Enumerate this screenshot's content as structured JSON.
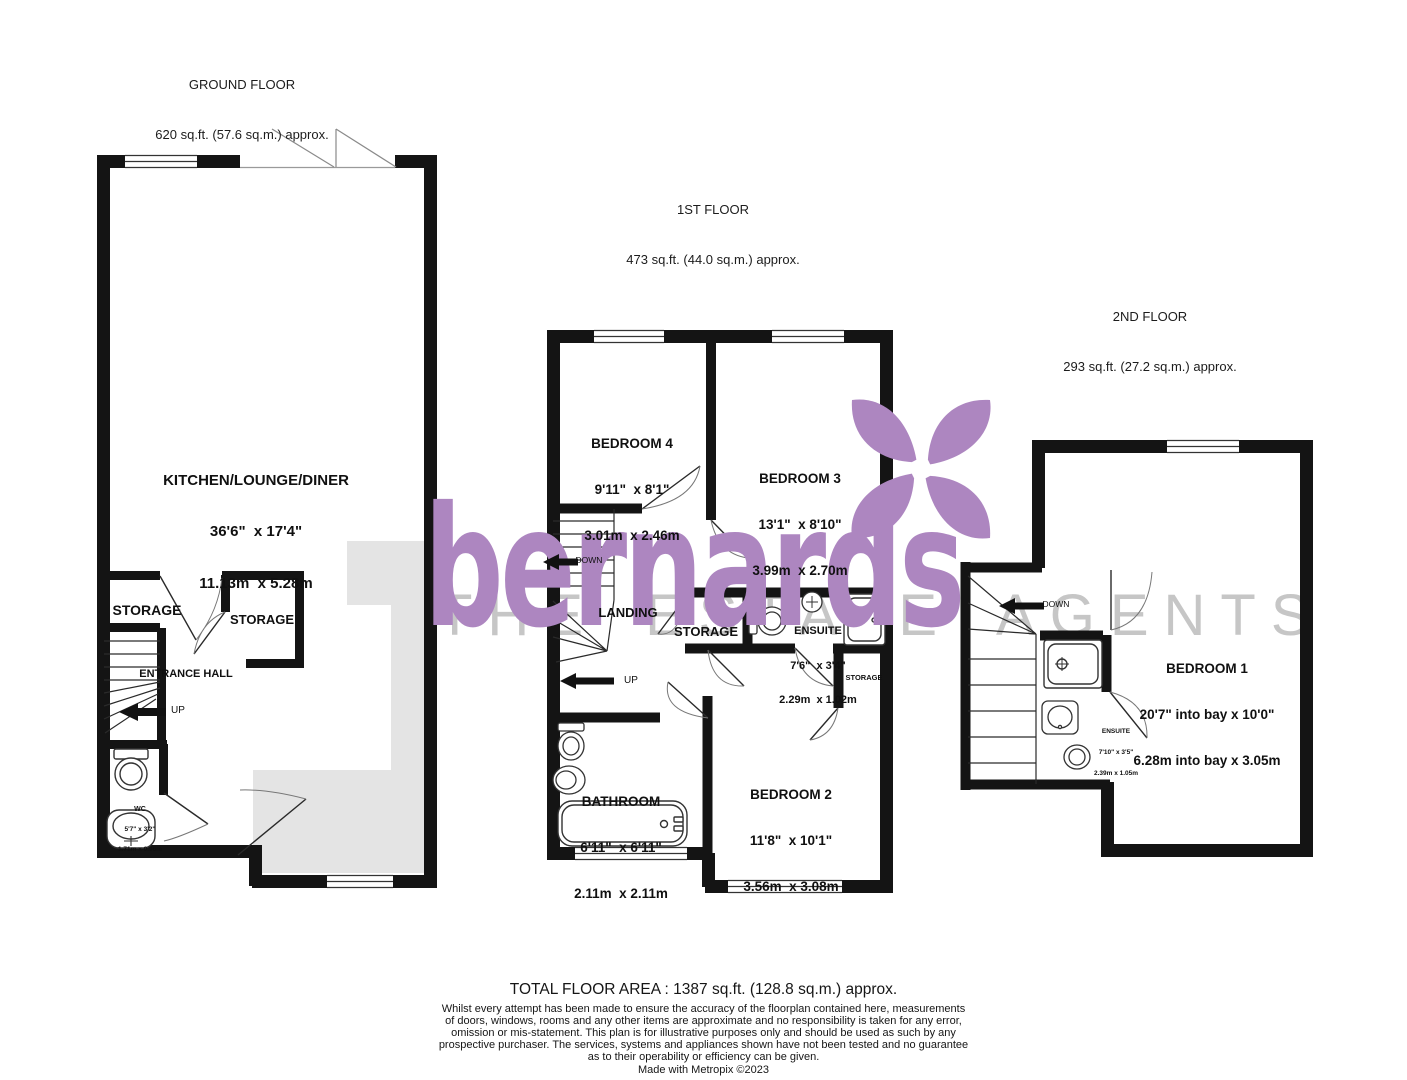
{
  "watermark": {
    "brand": "bernards",
    "tagline": "THE ESTATE AGENTS",
    "brand_color": "#ad86c0",
    "tagline_color": "#c6c6c6",
    "logo_flower": "four-petal-flower-icon"
  },
  "floors": {
    "ground": {
      "title": "GROUND FLOOR",
      "area": "620 sq.ft. (57.6 sq.m.) approx.",
      "kitchen": {
        "name": "KITCHEN/LOUNGE/DINER",
        "imperial": "36'6\"  x 17'4\"",
        "metric": "11.13m  x 5.28m"
      },
      "storage_left": "STORAGE",
      "storage_right": "STORAGE",
      "entrance": "ENTRANCE HALL",
      "wc": {
        "name": "WC",
        "imperial": "5'7\" x 3'2\"",
        "metric": "1.71m x 0.96m"
      },
      "up": "UP"
    },
    "first": {
      "title": "1ST FLOOR",
      "area": "473 sq.ft. (44.0 sq.m.) approx.",
      "bedroom4": {
        "name": "BEDROOM 4",
        "imperial": "9'11\"  x 8'1\"",
        "metric": "3.01m  x 2.46m"
      },
      "bedroom3": {
        "name": "BEDROOM 3",
        "imperial": "13'1\"  x 8'10\"",
        "metric": "3.99m  x 2.70m"
      },
      "landing": "LANDING",
      "storage": "STORAGE",
      "ensuite": {
        "name": "ENSUITE",
        "imperial": "7'6\"  x 3'4\"",
        "metric": "2.29m  x 1.02m"
      },
      "storage_small": "STORAGE",
      "bathroom": {
        "name": "BATHROOM",
        "imperial": "6'11\"  x 6'11\"",
        "metric": "2.11m  x 2.11m"
      },
      "bedroom2": {
        "name": "BEDROOM 2",
        "imperial": "11'8\"  x 10'1\"",
        "metric": "3.56m  x 3.08m"
      },
      "down": "DOWN",
      "up": "UP"
    },
    "second": {
      "title": "2ND FLOOR",
      "area": "293 sq.ft. (27.2 sq.m.) approx.",
      "bedroom1": {
        "name": "BEDROOM 1",
        "imperial": "20'7\" into bay x 10'0\"",
        "metric": "6.28m into bay x 3.05m"
      },
      "ensuite": {
        "name": "ENSUITE",
        "imperial": "7'10\" x 3'5\"",
        "metric": "2.39m x 1.05m"
      },
      "down": "DOWN"
    }
  },
  "footer": {
    "total": "TOTAL FLOOR AREA : 1387 sq.ft. (128.8 sq.m.) approx.",
    "disclaimer": [
      "Whilst every attempt has been made to ensure the accuracy of the floorplan contained here, measurements",
      "of doors, windows, rooms and any other items are approximate and no responsibility is taken for any error,",
      "omission or mis-statement. This plan is for illustrative purposes only and should be used as such by any",
      "prospective purchaser. The services, systems and appliances shown have not been tested and no guarantee",
      "as to their operability or efficiency can be given."
    ],
    "credit": "Made with Metropix ©2023"
  }
}
